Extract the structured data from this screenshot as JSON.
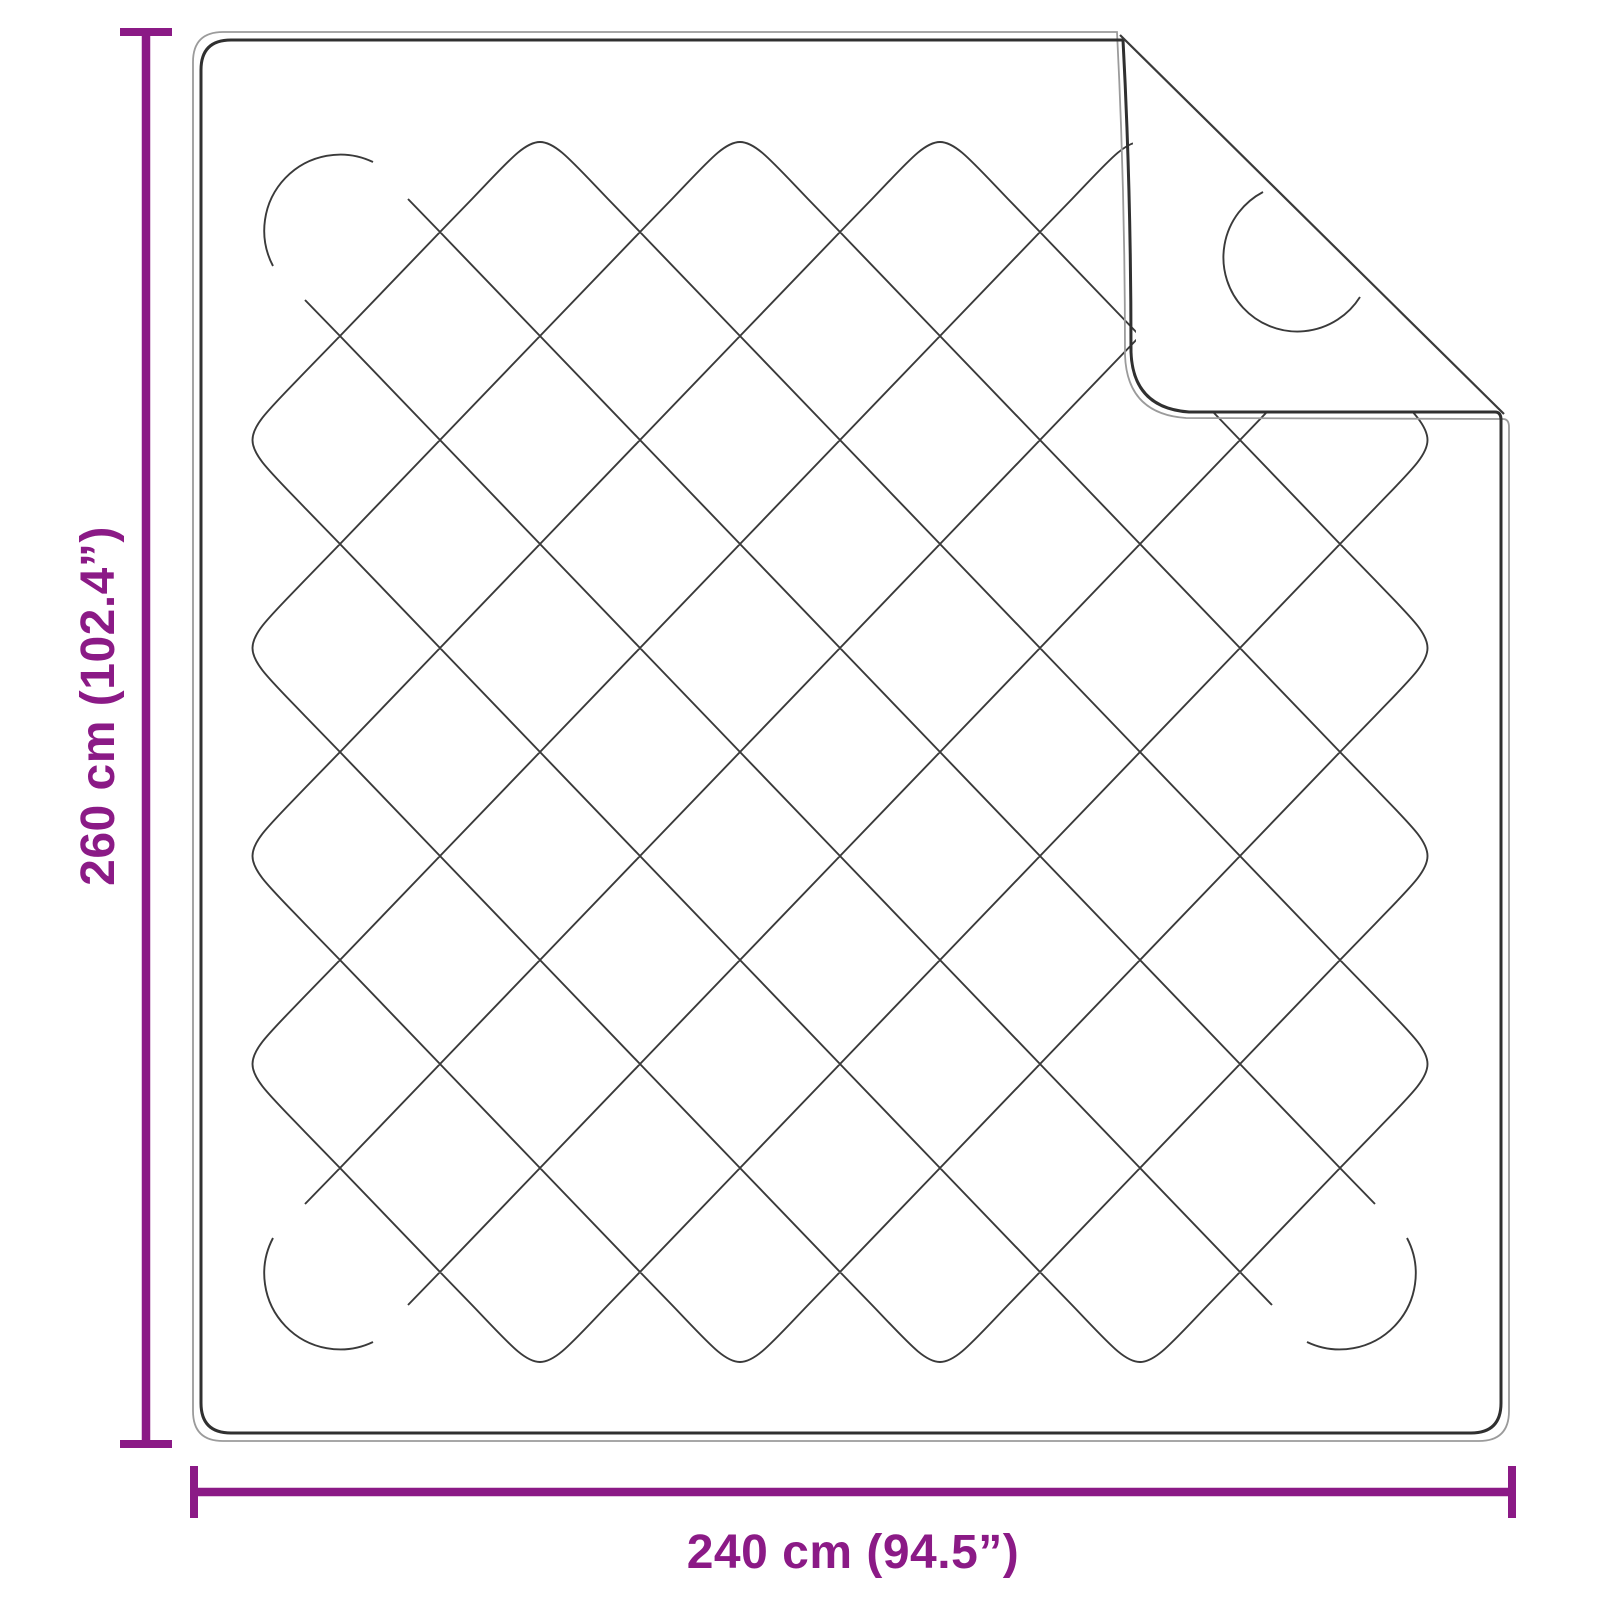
{
  "diagram": {
    "product": "quilted-blanket-with-folded-corner",
    "dimensions": {
      "height": {
        "label": "260 cm (102.4”)",
        "cm": "260 cm",
        "inches": "102.4”"
      },
      "width": {
        "label": "240 cm (94.5”)",
        "cm": "240 cm",
        "inches": "94.5”"
      }
    },
    "colors": {
      "accent": "#8B1A86",
      "stitch": "#3a3a3a",
      "outline_thin": "#9b9b9b",
      "outline_thick": "#303030",
      "background": "#ffffff"
    }
  }
}
